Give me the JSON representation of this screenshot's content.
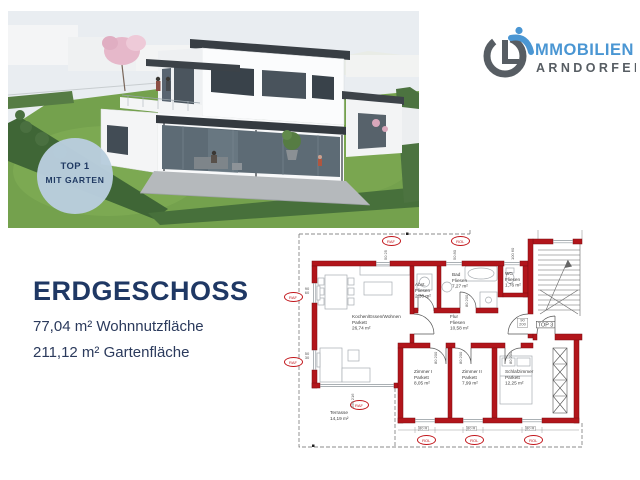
{
  "badge": {
    "line1": "TOP 1",
    "line2": "MIT GARTEN",
    "bg": "#b9cede",
    "fg": "#1f3864"
  },
  "logo": {
    "text_top": "MMOBILIEN",
    "text_bottom": "ARNDORFER",
    "accent": "#4a96d3",
    "gray": "#575d63"
  },
  "info": {
    "title": "ERDGESCHOSS",
    "area_line1": "77,04 m² Wohnnutzfläche",
    "area_line2": "211,12 m² Gartenfläche"
  },
  "floorplan": {
    "wall_color": "#b2151b",
    "marker_raf": "RAF",
    "marker_rol": "ROL",
    "unit_label": "TOP 3",
    "rooms": [
      {
        "name": "Kochen/Essen/Wohnen",
        "floor": "Parkett",
        "area": "26,74 m²"
      },
      {
        "name": "Abst.",
        "floor": "Fliesen",
        "area": "2,30 m²"
      },
      {
        "name": "Bad",
        "floor": "Fliesen",
        "area": "7,27 m²"
      },
      {
        "name": "WC",
        "floor": "Fliesen",
        "area": "1,76 m²"
      },
      {
        "name": "Flur",
        "floor": "Fliesen",
        "area": "10,58 m²"
      },
      {
        "name": "Zimmer I",
        "floor": "Parkett",
        "area": "8,05 m²"
      },
      {
        "name": "Zimmer II",
        "floor": "Parkett",
        "area": "7,99 m²"
      },
      {
        "name": "Schlafzimmer",
        "floor": "Parkett",
        "area": "12,25 m²"
      },
      {
        "name": "Terrasse",
        "floor": "",
        "area": "14,19 m²"
      }
    ],
    "dims": {
      "top1": "50 25",
      "top2": "50 80",
      "wc": "100 60",
      "left1": "90 60",
      "left2": "50 30",
      "terrace": "250 216",
      "entry": "90 200",
      "door": "80 200",
      "bottom": "80 R"
    }
  }
}
